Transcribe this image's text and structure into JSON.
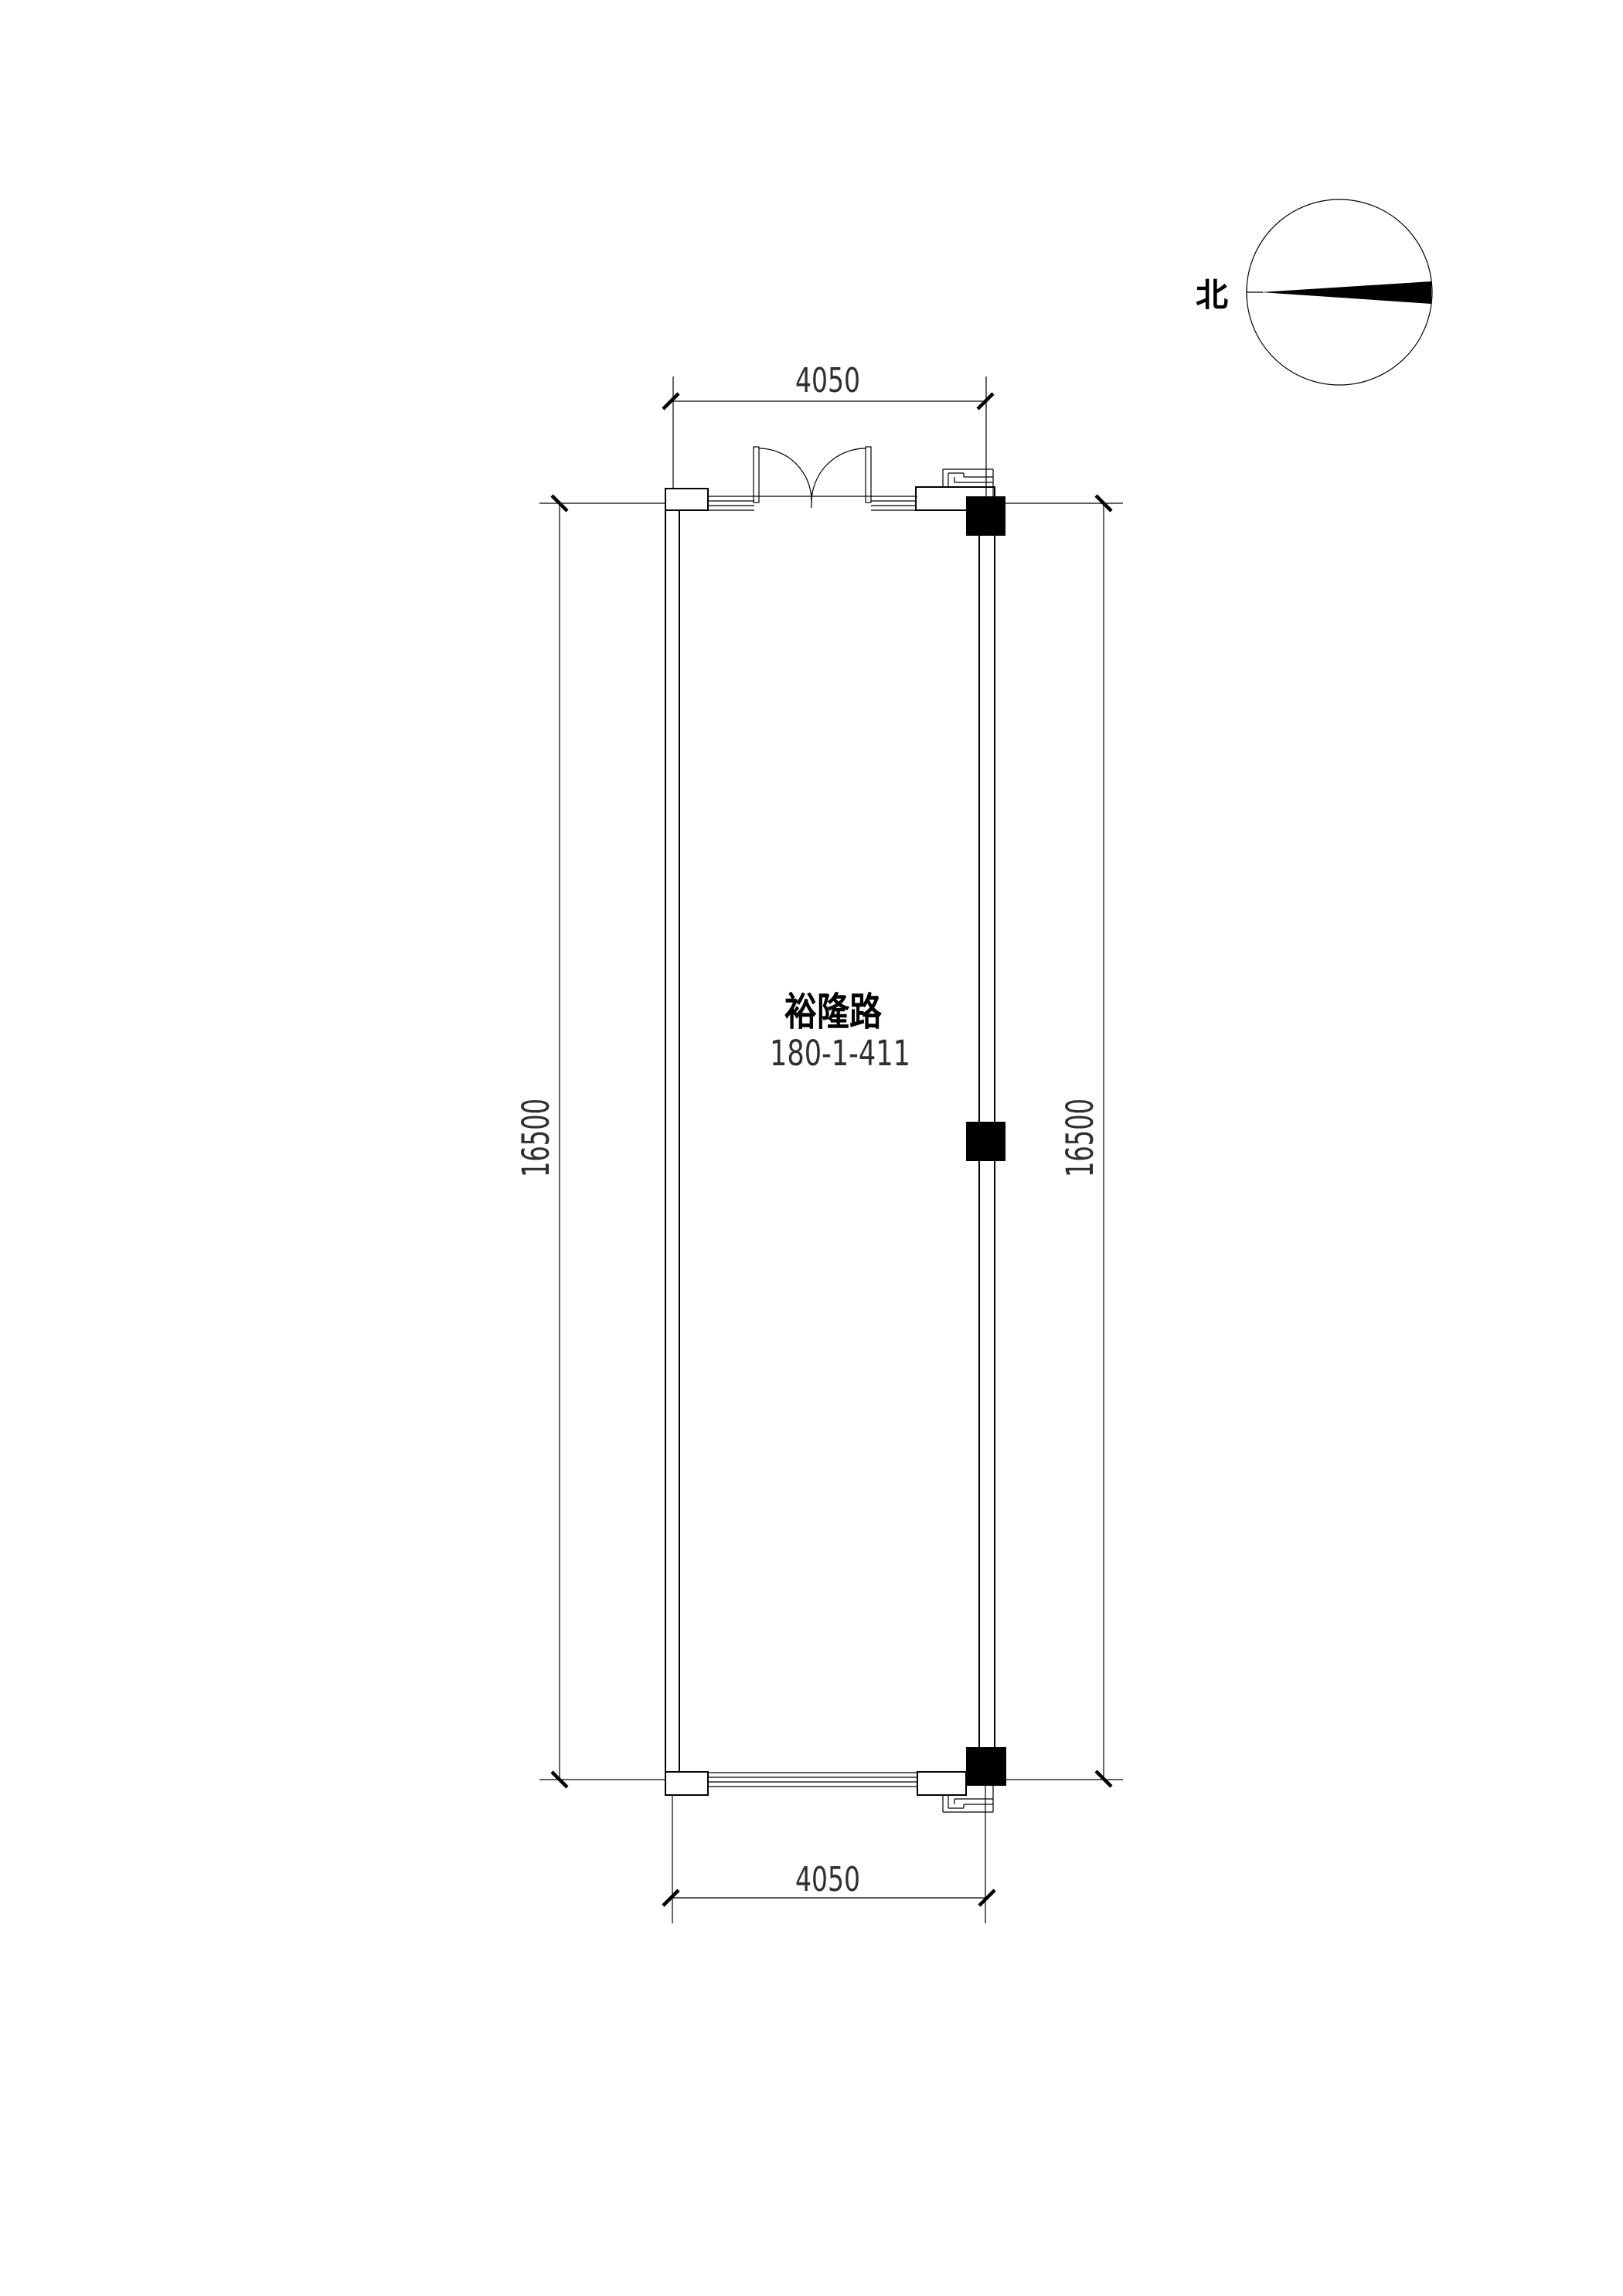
{
  "page": {
    "background": "#ffffff"
  },
  "compass": {
    "north_label": "北"
  },
  "room": {
    "street": "裕隆路",
    "number": "180-1-411"
  },
  "dimensions": {
    "top_width": "4050",
    "bottom_width": "4050",
    "left_height": "16500",
    "right_height": "16500"
  },
  "colors": {
    "line": "#000000",
    "dim_text": "#2f2f2f",
    "background": "#ffffff"
  }
}
